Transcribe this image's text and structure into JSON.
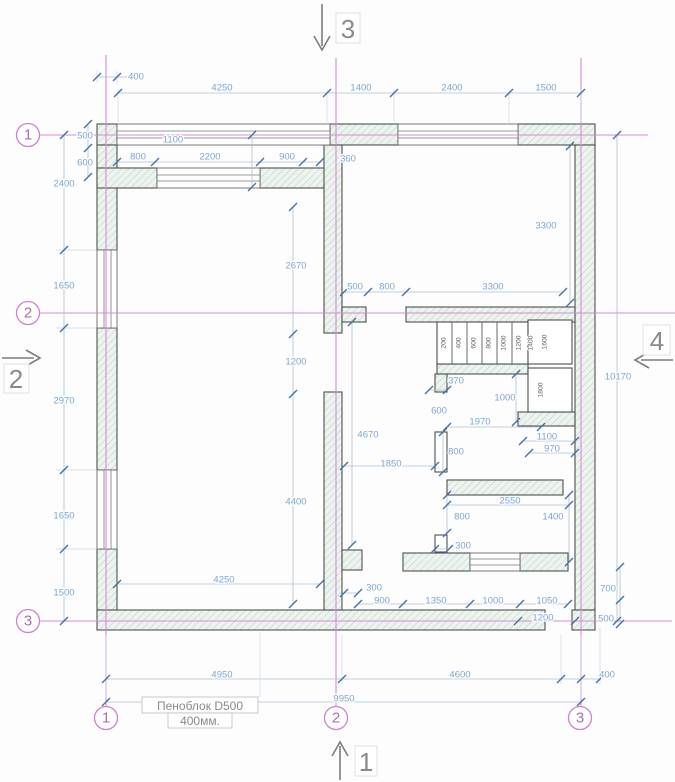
{
  "drawing": {
    "material_label": {
      "line1": "Пеноблок D500",
      "line2": "400мм."
    }
  },
  "axes": {
    "left": [
      "1",
      "2",
      "3"
    ],
    "bottom": [
      "1",
      "2",
      "3"
    ]
  },
  "sections": {
    "top": "3",
    "bottom": "1",
    "left": "2",
    "right": "4"
  },
  "dim_labels": [
    {
      "t": "400",
      "x": 136,
      "y": 77
    },
    {
      "t": "4250",
      "x": 222,
      "y": 88
    },
    {
      "t": "1400",
      "x": 361,
      "y": 88
    },
    {
      "t": "2400",
      "x": 452,
      "y": 88
    },
    {
      "t": "1500",
      "x": 546,
      "y": 88
    },
    {
      "t": "500",
      "x": 85,
      "y": 136
    },
    {
      "t": "1100",
      "x": 173,
      "y": 140
    },
    {
      "t": "600",
      "x": 85,
      "y": 163
    },
    {
      "t": "800",
      "x": 138,
      "y": 157
    },
    {
      "t": "2200",
      "x": 210,
      "y": 157
    },
    {
      "t": "900",
      "x": 287,
      "y": 157
    },
    {
      "t": "360",
      "x": 348,
      "y": 159
    },
    {
      "t": "2400",
      "x": 64,
      "y": 184
    },
    {
      "t": "1650",
      "x": 64,
      "y": 286
    },
    {
      "t": "2970",
      "x": 64,
      "y": 401
    },
    {
      "t": "1650",
      "x": 64,
      "y": 516
    },
    {
      "t": "1500",
      "x": 64,
      "y": 593
    },
    {
      "t": "3300",
      "x": 546,
      "y": 226
    },
    {
      "t": "2670",
      "x": 296,
      "y": 266
    },
    {
      "t": "500",
      "x": 355,
      "y": 287
    },
    {
      "t": "800",
      "x": 387,
      "y": 287
    },
    {
      "t": "3300",
      "x": 493,
      "y": 287
    },
    {
      "t": "1200",
      "x": 296,
      "y": 362
    },
    {
      "t": "10170",
      "x": 618,
      "y": 377
    },
    {
      "t": "370",
      "x": 456,
      "y": 381
    },
    {
      "t": "1000",
      "x": 505,
      "y": 398
    },
    {
      "t": "600",
      "x": 439,
      "y": 411
    },
    {
      "t": "1970",
      "x": 480,
      "y": 422
    },
    {
      "t": "4670",
      "x": 368,
      "y": 435
    },
    {
      "t": "1100",
      "x": 547,
      "y": 437
    },
    {
      "t": "970",
      "x": 552,
      "y": 449
    },
    {
      "t": "800",
      "x": 456,
      "y": 452
    },
    {
      "t": "1850",
      "x": 391,
      "y": 464
    },
    {
      "t": "4400",
      "x": 296,
      "y": 502
    },
    {
      "t": "2550",
      "x": 510,
      "y": 501
    },
    {
      "t": "800",
      "x": 462,
      "y": 517
    },
    {
      "t": "1400",
      "x": 553,
      "y": 517
    },
    {
      "t": "300",
      "x": 463,
      "y": 546
    },
    {
      "t": "4250",
      "x": 224,
      "y": 580
    },
    {
      "t": "300",
      "x": 374,
      "y": 588
    },
    {
      "t": "700",
      "x": 608,
      "y": 589
    },
    {
      "t": "900",
      "x": 382,
      "y": 601
    },
    {
      "t": "1350",
      "x": 436,
      "y": 601
    },
    {
      "t": "1000",
      "x": 493,
      "y": 601
    },
    {
      "t": "1050",
      "x": 547,
      "y": 601
    },
    {
      "t": "1200",
      "x": 543,
      "y": 618
    },
    {
      "t": "500",
      "x": 606,
      "y": 619
    },
    {
      "t": "4950",
      "x": 222,
      "y": 675
    },
    {
      "t": "4600",
      "x": 460,
      "y": 675
    },
    {
      "t": "400",
      "x": 607,
      "y": 675
    },
    {
      "t": "9950",
      "x": 344,
      "y": 699
    }
  ],
  "stair_labels": [
    {
      "t": "200",
      "x": 444,
      "y": 343
    },
    {
      "t": "400",
      "x": 459,
      "y": 343
    },
    {
      "t": "600",
      "x": 474,
      "y": 343
    },
    {
      "t": "800",
      "x": 489,
      "y": 343
    },
    {
      "t": "1000",
      "x": 504,
      "y": 343
    },
    {
      "t": "1200",
      "x": 519,
      "y": 343
    },
    {
      "t": "1400",
      "x": 531,
      "y": 343
    },
    {
      "t": "1600",
      "x": 545,
      "y": 342
    },
    {
      "t": "1800",
      "x": 541,
      "y": 390
    }
  ]
}
